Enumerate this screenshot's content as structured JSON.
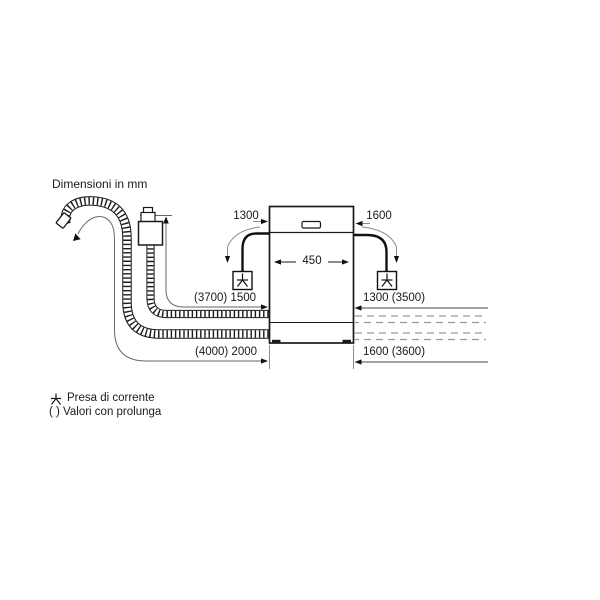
{
  "title": "Dimensioni in mm",
  "diagram": {
    "type": "dishwasher-installation-dimensions",
    "appliance_width_label": "450",
    "labels": {
      "cord_to_socket_left": "1300",
      "cord_to_socket_right": "1600",
      "hose_left_upper": "(3700) 1500",
      "hose_right_upper": "1300 (3500)",
      "hose_left_lower": "(4000) 2000",
      "hose_right_lower": "1600 (3600)"
    }
  },
  "legend": {
    "socket_label": "Presa di corrente",
    "extension_label": "( ) Valori con prolunga"
  },
  "icons": {
    "socket": "trident-plug-icon",
    "drain_arrow": "down-left-arrow-icon"
  },
  "colors": {
    "line": "#1a1a1a",
    "dimension": "#666666",
    "sweep": "#8c8c8c",
    "dashed": "#9a9a9a",
    "background": "#ffffff"
  }
}
